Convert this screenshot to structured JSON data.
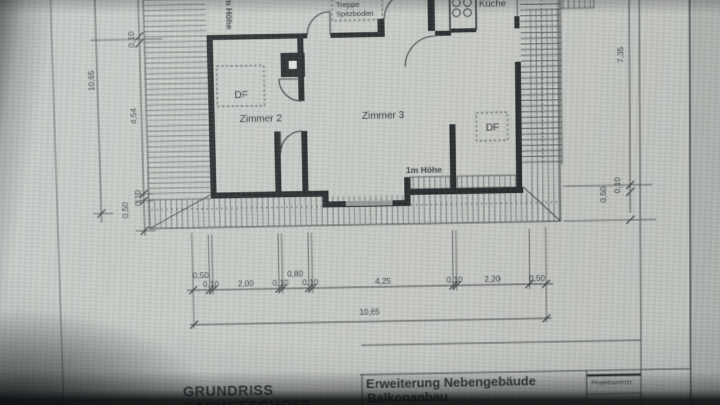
{
  "drawing": {
    "rooms": {
      "zimmer2": "Zimmer 2",
      "zimmer3": "Zimmer 3",
      "kueche": "Küche"
    },
    "annotations": {
      "stair_label_line1": "Treppe",
      "stair_label_line2": "Spitzboden",
      "roof_window_abbr": "DF",
      "knee_wall_height": "1m Höhe"
    },
    "dimensions": {
      "left": {
        "total": "10,65",
        "top_wall": "0,10",
        "room_depth": "4,54",
        "bottom_wall": "0,10",
        "eaves": "0,50"
      },
      "right": {
        "height": "7,35",
        "wall": "0,10",
        "eaves": "0,50"
      },
      "bottom": {
        "segments": [
          "0,50",
          "0,10",
          "2,00",
          "0,10",
          "0,80",
          "0,10",
          "4,25",
          "0,10",
          "2,20",
          "0,50"
        ],
        "total": "10,65"
      }
    },
    "title_block": {
      "title_line1": "GRUNDRISS",
      "title_line2": "DACHGESCHOSS",
      "project_line1": "Erweiterung Nebengebäude",
      "project_line2": "Balkonanbau",
      "project_number_label": "Projektnummer"
    }
  }
}
